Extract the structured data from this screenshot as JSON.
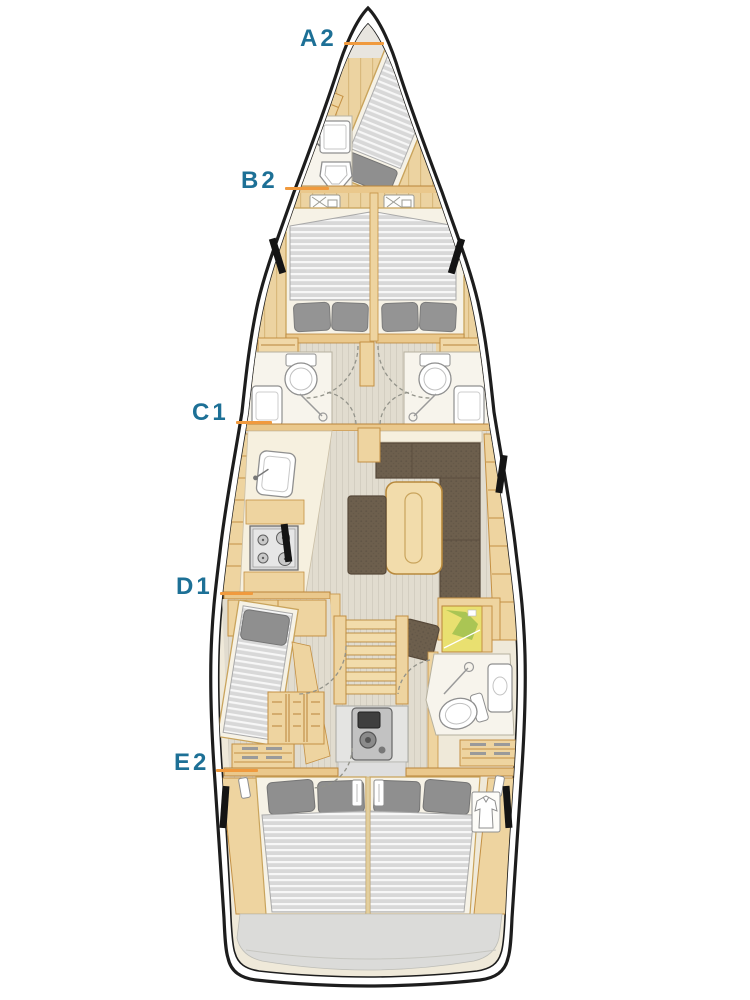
{
  "diagram": {
    "type": "sailing-yacht-interior-floor-plan",
    "orientation": "bow-up",
    "labels": [
      {
        "id": "A2",
        "text": "A2",
        "area": "bow-cabin"
      },
      {
        "id": "B2",
        "text": "B2",
        "area": "bow-head"
      },
      {
        "id": "C1",
        "text": "C1",
        "area": "forward-heads-galley-bulkhead"
      },
      {
        "id": "D1",
        "text": "D1",
        "area": "port-mid-cabin"
      },
      {
        "id": "E2",
        "text": "E2",
        "area": "aft-cabins"
      }
    ],
    "colors": {
      "label_text": "#1d7096",
      "leader_line": "#f09a3e",
      "hull_outline": "#1d1d1d",
      "hull_interior": "#efe9d9",
      "wood_light": "#eed4a0",
      "wood_border": "#c49043",
      "bulkhead": "#eac88c",
      "counter_cream": "#f6f0df",
      "floor_stripe": "#e1dccf",
      "plank_wood": "#ecd3a1",
      "mattress": "#d8d8d8",
      "pillow": "#949494",
      "upholstery": "#6d5f4d",
      "fixture_white": "#ffffff",
      "fixture_stroke": "#8f8f8f",
      "transom_gray": "#dbdbd9",
      "chart_yellow": "#e9e070",
      "chart_green": "#9fbf4f",
      "hull_window_black": "#141414"
    }
  }
}
